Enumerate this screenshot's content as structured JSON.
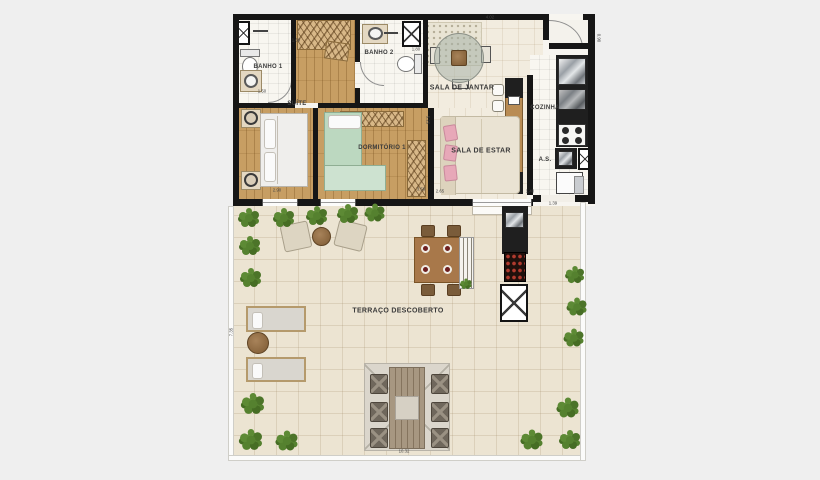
{
  "rooms": {
    "banho1": {
      "label": "BANHO 1"
    },
    "banho2": {
      "label": "BANHO 2"
    },
    "suite": {
      "label": "SUÍTE"
    },
    "dormitorio1": {
      "label": "DORMITÓRIO 1"
    },
    "sala_jantar": {
      "label": "SALA DE JANTAR"
    },
    "sala_estar": {
      "label": "SALA DE ESTAR"
    },
    "cozinha": {
      "label": "COZINHA"
    },
    "area_servico": {
      "label": "A.S."
    },
    "terraco": {
      "label": "TERRAÇO DESCOBERTO"
    }
  },
  "dimensions": [
    {
      "t": "4.02",
      "x": 490,
      "y": 18,
      "r": 0
    },
    {
      "t": "0.90",
      "x": 598,
      "y": 38,
      "r": 90
    },
    {
      "t": "1.60",
      "x": 296,
      "y": 41,
      "r": 0
    },
    {
      "t": "1.80",
      "x": 416,
      "y": 50,
      "r": 0
    },
    {
      "t": "1.50",
      "x": 262,
      "y": 92,
      "r": 0
    },
    {
      "t": "5.25",
      "x": 427,
      "y": 120,
      "r": 90
    },
    {
      "t": "2.90",
      "x": 277,
      "y": 191,
      "r": 0
    },
    {
      "t": "3.56",
      "x": 421,
      "y": 190,
      "r": 0
    },
    {
      "t": "2.65",
      "x": 440,
      "y": 192,
      "r": 0
    },
    {
      "t": "1.40",
      "x": 530,
      "y": 192,
      "r": 0
    },
    {
      "t": "1.39",
      "x": 553,
      "y": 204,
      "r": 0
    },
    {
      "t": "7.35",
      "x": 232,
      "y": 332,
      "r": -90
    },
    {
      "t": "10.32",
      "x": 404,
      "y": 452,
      "r": 0
    }
  ],
  "plants": [
    [
      249,
      218,
      1
    ],
    [
      284,
      218,
      1
    ],
    [
      317,
      216,
      1
    ],
    [
      348,
      214,
      1
    ],
    [
      375,
      213,
      0.95
    ],
    [
      250,
      246,
      1
    ],
    [
      251,
      278,
      1
    ],
    [
      253,
      404,
      1.1
    ],
    [
      251,
      440,
      1.1
    ],
    [
      287,
      441,
      1.05
    ],
    [
      575,
      275,
      0.9
    ],
    [
      577,
      307,
      0.95
    ],
    [
      574,
      338,
      0.95
    ],
    [
      568,
      408,
      1.05
    ],
    [
      532,
      440,
      1.05
    ],
    [
      570,
      440,
      1
    ],
    [
      466,
      284,
      0.55
    ]
  ],
  "colors": {
    "background": "#efefef",
    "wall": "#161616",
    "wood_floor": "#c79e63",
    "terrace_floor": "#ece4d2",
    "plant_green": "#55812f",
    "accent_pink": "#e7a8b8",
    "grill_red": "#b03a2e",
    "bed_green": "#bcd8c0"
  }
}
